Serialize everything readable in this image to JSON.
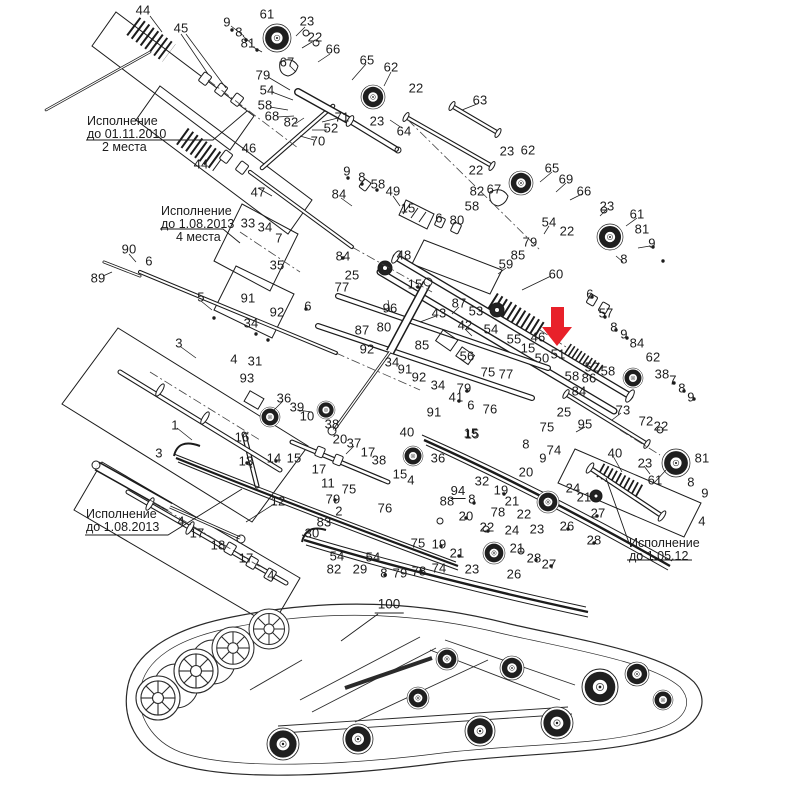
{
  "figure": {
    "type": "exploded-parts-diagram",
    "subject": "snowmobile rear suspension and track assembly",
    "background": "#ffffff",
    "line_color": "#1b1b1b",
    "highlight_arrow_color": "#e8212a",
    "highlighted_part": "51"
  },
  "annotations": [
    {
      "id": "version-2010",
      "x": 87,
      "y": 115,
      "lines": [
        "Исполнение",
        "до 01.11.2010",
        "2 места"
      ]
    },
    {
      "id": "version-2013-4m",
      "x": 161,
      "y": 205,
      "lines": [
        "Исполнение",
        "до 1.08.2013",
        "4 места"
      ]
    },
    {
      "id": "version-2013",
      "x": 86,
      "y": 508,
      "lines": [
        "Исполнение",
        "до 1.08.2013"
      ]
    },
    {
      "id": "version-2012",
      "x": 629,
      "y": 537,
      "lines": [
        "Исполнение",
        "до 1.05.12"
      ]
    }
  ],
  "assembly_ref": {
    "label": "100",
    "x": 389,
    "y": 605
  },
  "part_labels": [
    {
      "n": "44",
      "x": 143,
      "y": 10
    },
    {
      "n": "45",
      "x": 181,
      "y": 28
    },
    {
      "n": "9",
      "x": 227,
      "y": 22
    },
    {
      "n": "8",
      "x": 239,
      "y": 32
    },
    {
      "n": "81",
      "x": 248,
      "y": 43
    },
    {
      "n": "61",
      "x": 267,
      "y": 14
    },
    {
      "n": "23",
      "x": 307,
      "y": 21
    },
    {
      "n": "22",
      "x": 315,
      "y": 37
    },
    {
      "n": "66",
      "x": 333,
      "y": 49
    },
    {
      "n": "67",
      "x": 287,
      "y": 62
    },
    {
      "n": "79",
      "x": 263,
      "y": 75
    },
    {
      "n": "54",
      "x": 267,
      "y": 90
    },
    {
      "n": "58",
      "x": 265,
      "y": 105
    },
    {
      "n": "68",
      "x": 272,
      "y": 116
    },
    {
      "n": "82",
      "x": 291,
      "y": 122
    },
    {
      "n": "71",
      "x": 342,
      "y": 117
    },
    {
      "n": "52",
      "x": 331,
      "y": 128
    },
    {
      "n": "70",
      "x": 318,
      "y": 141
    },
    {
      "n": "65",
      "x": 367,
      "y": 60
    },
    {
      "n": "62",
      "x": 391,
      "y": 67
    },
    {
      "n": "22",
      "x": 416,
      "y": 88
    },
    {
      "n": "23",
      "x": 377,
      "y": 121
    },
    {
      "n": "64",
      "x": 404,
      "y": 131
    },
    {
      "n": "63",
      "x": 480,
      "y": 100
    },
    {
      "n": "23",
      "x": 507,
      "y": 151
    },
    {
      "n": "62",
      "x": 528,
      "y": 150
    },
    {
      "n": "22",
      "x": 476,
      "y": 170
    },
    {
      "n": "65",
      "x": 552,
      "y": 168
    },
    {
      "n": "69",
      "x": 566,
      "y": 179
    },
    {
      "n": "66",
      "x": 584,
      "y": 191
    },
    {
      "n": "82",
      "x": 477,
      "y": 191
    },
    {
      "n": "67",
      "x": 494,
      "y": 189
    },
    {
      "n": "58",
      "x": 472,
      "y": 206
    },
    {
      "n": "6",
      "x": 439,
      "y": 218
    },
    {
      "n": "80",
      "x": 457,
      "y": 220
    },
    {
      "n": "23",
      "x": 607,
      "y": 206
    },
    {
      "n": "61",
      "x": 637,
      "y": 214
    },
    {
      "n": "81",
      "x": 642,
      "y": 229
    },
    {
      "n": "9",
      "x": 652,
      "y": 243
    },
    {
      "n": "8",
      "x": 624,
      "y": 259
    },
    {
      "n": "22",
      "x": 567,
      "y": 231
    },
    {
      "n": "54",
      "x": 549,
      "y": 222
    },
    {
      "n": "46",
      "x": 249,
      "y": 148
    },
    {
      "n": "44",
      "x": 201,
      "y": 164
    },
    {
      "n": "47",
      "x": 258,
      "y": 192
    },
    {
      "n": "33",
      "x": 248,
      "y": 223
    },
    {
      "n": "34",
      "x": 265,
      "y": 227
    },
    {
      "n": "7",
      "x": 279,
      "y": 238
    },
    {
      "n": "35",
      "x": 277,
      "y": 265
    },
    {
      "n": "90",
      "x": 129,
      "y": 249
    },
    {
      "n": "6",
      "x": 149,
      "y": 261
    },
    {
      "n": "89",
      "x": 98,
      "y": 278
    },
    {
      "n": "5",
      "x": 201,
      "y": 297
    },
    {
      "n": "91",
      "x": 248,
      "y": 298
    },
    {
      "n": "92",
      "x": 277,
      "y": 312
    },
    {
      "n": "34",
      "x": 251,
      "y": 323
    },
    {
      "n": "6",
      "x": 308,
      "y": 306
    },
    {
      "n": "9",
      "x": 347,
      "y": 171
    },
    {
      "n": "8",
      "x": 362,
      "y": 177
    },
    {
      "n": "58",
      "x": 378,
      "y": 184
    },
    {
      "n": "49",
      "x": 393,
      "y": 191
    },
    {
      "n": "84",
      "x": 339,
      "y": 194
    },
    {
      "n": "15",
      "x": 408,
      "y": 208
    },
    {
      "n": "84",
      "x": 343,
      "y": 256
    },
    {
      "n": "25",
      "x": 352,
      "y": 275
    },
    {
      "n": "77",
      "x": 342,
      "y": 287
    },
    {
      "n": "48",
      "x": 404,
      "y": 255
    },
    {
      "n": "15",
      "x": 415,
      "y": 284
    },
    {
      "n": "96",
      "x": 390,
      "y": 308
    },
    {
      "n": "79",
      "x": 530,
      "y": 242
    },
    {
      "n": "85",
      "x": 518,
      "y": 255
    },
    {
      "n": "59",
      "x": 506,
      "y": 264
    },
    {
      "n": "60",
      "x": 556,
      "y": 274
    },
    {
      "n": "87",
      "x": 459,
      "y": 303
    },
    {
      "n": "43",
      "x": 439,
      "y": 313
    },
    {
      "n": "53",
      "x": 476,
      "y": 311
    },
    {
      "n": "42",
      "x": 465,
      "y": 325
    },
    {
      "n": "54",
      "x": 491,
      "y": 329
    },
    {
      "n": "55",
      "x": 514,
      "y": 339
    },
    {
      "n": "46",
      "x": 538,
      "y": 337
    },
    {
      "n": "15",
      "x": 528,
      "y": 348
    },
    {
      "n": "50",
      "x": 542,
      "y": 358
    },
    {
      "n": "51",
      "x": 558,
      "y": 354
    },
    {
      "n": "6",
      "x": 590,
      "y": 294
    },
    {
      "n": "57",
      "x": 606,
      "y": 313
    },
    {
      "n": "8",
      "x": 614,
      "y": 327
    },
    {
      "n": "9",
      "x": 624,
      "y": 334
    },
    {
      "n": "84",
      "x": 637,
      "y": 343
    },
    {
      "n": "52",
      "x": 592,
      "y": 367
    },
    {
      "n": "58",
      "x": 608,
      "y": 371
    },
    {
      "n": "86",
      "x": 589,
      "y": 378
    },
    {
      "n": "58",
      "x": 572,
      "y": 376
    },
    {
      "n": "84",
      "x": 579,
      "y": 391
    },
    {
      "n": "62",
      "x": 653,
      "y": 357
    },
    {
      "n": "38",
      "x": 662,
      "y": 374
    },
    {
      "n": "7",
      "x": 673,
      "y": 380
    },
    {
      "n": "8",
      "x": 682,
      "y": 388
    },
    {
      "n": "9",
      "x": 691,
      "y": 397
    },
    {
      "n": "25",
      "x": 564,
      "y": 412
    },
    {
      "n": "95",
      "x": 585,
      "y": 424
    },
    {
      "n": "73",
      "x": 623,
      "y": 410
    },
    {
      "n": "72",
      "x": 646,
      "y": 421
    },
    {
      "n": "22",
      "x": 661,
      "y": 426
    },
    {
      "n": "40",
      "x": 615,
      "y": 453
    },
    {
      "n": "23",
      "x": 645,
      "y": 463
    },
    {
      "n": "61",
      "x": 655,
      "y": 480
    },
    {
      "n": "81",
      "x": 702,
      "y": 458
    },
    {
      "n": "8",
      "x": 691,
      "y": 482
    },
    {
      "n": "9",
      "x": 705,
      "y": 493
    },
    {
      "n": "4",
      "x": 702,
      "y": 521
    },
    {
      "n": "27",
      "x": 598,
      "y": 513
    },
    {
      "n": "28",
      "x": 594,
      "y": 540
    },
    {
      "n": "87",
      "x": 362,
      "y": 330
    },
    {
      "n": "80",
      "x": 384,
      "y": 327
    },
    {
      "n": "92",
      "x": 367,
      "y": 349
    },
    {
      "n": "34",
      "x": 392,
      "y": 362
    },
    {
      "n": "91",
      "x": 405,
      "y": 369
    },
    {
      "n": "92",
      "x": 419,
      "y": 377
    },
    {
      "n": "34",
      "x": 438,
      "y": 385
    },
    {
      "n": "85",
      "x": 422,
      "y": 345
    },
    {
      "n": "56",
      "x": 467,
      "y": 356
    },
    {
      "n": "75",
      "x": 488,
      "y": 372
    },
    {
      "n": "77",
      "x": 506,
      "y": 374
    },
    {
      "n": "79",
      "x": 464,
      "y": 388
    },
    {
      "n": "41",
      "x": 456,
      "y": 397
    },
    {
      "n": "76",
      "x": 490,
      "y": 409
    },
    {
      "n": "6",
      "x": 471,
      "y": 405
    },
    {
      "n": "91",
      "x": 434,
      "y": 412
    },
    {
      "n": "40",
      "x": 407,
      "y": 432
    },
    {
      "n": "36",
      "x": 438,
      "y": 458
    },
    {
      "n": "15",
      "x": 471,
      "y": 433
    },
    {
      "n": "15",
      "x": 400,
      "y": 474
    },
    {
      "n": "4",
      "x": 411,
      "y": 480
    },
    {
      "n": "3",
      "x": 179,
      "y": 343
    },
    {
      "n": "4",
      "x": 234,
      "y": 359
    },
    {
      "n": "31",
      "x": 255,
      "y": 361
    },
    {
      "n": "93",
      "x": 247,
      "y": 378
    },
    {
      "n": "36",
      "x": 284,
      "y": 398
    },
    {
      "n": "1",
      "x": 175,
      "y": 425
    },
    {
      "n": "16",
      "x": 242,
      "y": 437
    },
    {
      "n": "13",
      "x": 246,
      "y": 461
    },
    {
      "n": "14",
      "x": 274,
      "y": 458
    },
    {
      "n": "15",
      "x": 294,
      "y": 458
    },
    {
      "n": "39",
      "x": 297,
      "y": 407
    },
    {
      "n": "10",
      "x": 307,
      "y": 416
    },
    {
      "n": "38",
      "x": 332,
      "y": 424
    },
    {
      "n": "20",
      "x": 340,
      "y": 439
    },
    {
      "n": "37",
      "x": 354,
      "y": 443
    },
    {
      "n": "17",
      "x": 319,
      "y": 469
    },
    {
      "n": "17",
      "x": 368,
      "y": 452
    },
    {
      "n": "38",
      "x": 379,
      "y": 460
    },
    {
      "n": "11",
      "x": 328,
      "y": 483
    },
    {
      "n": "12",
      "x": 278,
      "y": 501
    },
    {
      "n": "75",
      "x": 349,
      "y": 489
    },
    {
      "n": "79",
      "x": 333,
      "y": 499
    },
    {
      "n": "2",
      "x": 339,
      "y": 511
    },
    {
      "n": "83",
      "x": 324,
      "y": 522
    },
    {
      "n": "30",
      "x": 312,
      "y": 533
    },
    {
      "n": "76",
      "x": 385,
      "y": 508
    },
    {
      "n": "54",
      "x": 337,
      "y": 556
    },
    {
      "n": "82",
      "x": 334,
      "y": 569
    },
    {
      "n": "29",
      "x": 360,
      "y": 569
    },
    {
      "n": "54",
      "x": 373,
      "y": 557
    },
    {
      "n": "8",
      "x": 384,
      "y": 573
    },
    {
      "n": "79",
      "x": 400,
      "y": 573
    },
    {
      "n": "78",
      "x": 419,
      "y": 571
    },
    {
      "n": "74",
      "x": 439,
      "y": 568
    },
    {
      "n": "75",
      "x": 418,
      "y": 543
    },
    {
      "n": "3",
      "x": 159,
      "y": 453
    },
    {
      "n": "4",
      "x": 181,
      "y": 521
    },
    {
      "n": "17",
      "x": 197,
      "y": 533
    },
    {
      "n": "18",
      "x": 218,
      "y": 545
    },
    {
      "n": "17",
      "x": 246,
      "y": 558
    },
    {
      "n": "4",
      "x": 271,
      "y": 575
    },
    {
      "n": "94",
      "x": 458,
      "y": 491,
      "u": true
    },
    {
      "n": "88",
      "x": 447,
      "y": 501
    },
    {
      "n": "8",
      "x": 472,
      "y": 499
    },
    {
      "n": "78",
      "x": 498,
      "y": 512
    },
    {
      "n": "20",
      "x": 466,
      "y": 516
    },
    {
      "n": "22",
      "x": 487,
      "y": 527
    },
    {
      "n": "19",
      "x": 439,
      "y": 544
    },
    {
      "n": "21",
      "x": 457,
      "y": 553
    },
    {
      "n": "23",
      "x": 472,
      "y": 569
    },
    {
      "n": "24",
      "x": 512,
      "y": 530
    },
    {
      "n": "21",
      "x": 517,
      "y": 548
    },
    {
      "n": "26",
      "x": 514,
      "y": 574
    },
    {
      "n": "28",
      "x": 534,
      "y": 558
    },
    {
      "n": "27",
      "x": 549,
      "y": 564
    },
    {
      "n": "32",
      "x": 482,
      "y": 481
    },
    {
      "n": "19",
      "x": 501,
      "y": 490
    },
    {
      "n": "21",
      "x": 512,
      "y": 501
    },
    {
      "n": "22",
      "x": 524,
      "y": 514
    },
    {
      "n": "23",
      "x": 537,
      "y": 529
    },
    {
      "n": "24",
      "x": 573,
      "y": 488
    },
    {
      "n": "21",
      "x": 584,
      "y": 497
    },
    {
      "n": "26",
      "x": 567,
      "y": 526
    },
    {
      "n": "75",
      "x": 547,
      "y": 427
    },
    {
      "n": "15",
      "x": 472,
      "y": 434
    },
    {
      "n": "8",
      "x": 526,
      "y": 444
    },
    {
      "n": "74",
      "x": 554,
      "y": 450
    },
    {
      "n": "9",
      "x": 543,
      "y": 458
    },
    {
      "n": "20",
      "x": 526,
      "y": 472
    }
  ]
}
